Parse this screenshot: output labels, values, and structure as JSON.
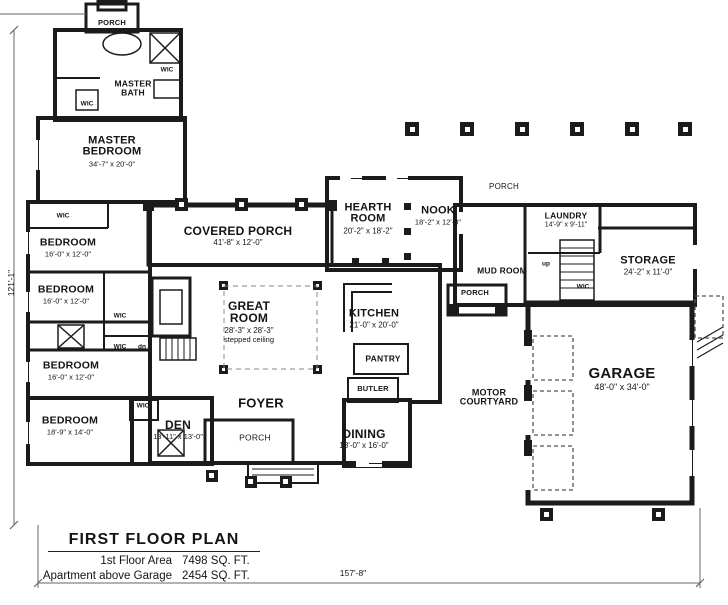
{
  "rooms": {
    "porch_nw": {
      "name": "PORCH"
    },
    "master_bath": {
      "name": "MASTER BATH"
    },
    "master_bedroom": {
      "name": "MASTER BEDROOM",
      "dims": "34'-7\" x 20'-0\""
    },
    "bedroom_1": {
      "name": "BEDROOM",
      "dims": "16'-0\" x 12'-0\""
    },
    "bedroom_2": {
      "name": "BEDROOM",
      "dims": "16'-0\" x 12'-0\""
    },
    "bedroom_3": {
      "name": "BEDROOM",
      "dims": "16'-0\" x 12'-0\""
    },
    "bedroom_4": {
      "name": "BEDROOM",
      "dims": "18'-9\" x 14'-0\""
    },
    "den": {
      "name": "DEN",
      "dims": "13'-11\" x 13'-0\""
    },
    "covered_porch": {
      "name": "COVERED PORCH",
      "dims": "41'-8\" x 12'-0\""
    },
    "great_room": {
      "name": "GREAT ROOM",
      "dims": "28'-3\" x 28'-3\"",
      "note": "stepped ceiling"
    },
    "foyer": {
      "name": "FOYER"
    },
    "porch_s": {
      "name": "PORCH"
    },
    "dining": {
      "name": "DINING",
      "dims": "18'-0\" x 16'-0\""
    },
    "butler": {
      "name": "BUTLER"
    },
    "pantry": {
      "name": "PANTRY"
    },
    "kitchen": {
      "name": "KITCHEN",
      "dims": "21'-0\" x 20'-0\""
    },
    "hearth_room": {
      "name": "HEARTH ROOM",
      "dims": "20'-2\" x 18'-2\""
    },
    "nook": {
      "name": "NOOK",
      "dims": "18'-2\" x 12'-0\""
    },
    "porch_ne": {
      "name": "PORCH"
    },
    "laundry": {
      "name": "LAUNDRY",
      "dims": "14'-9\" x 9'-11\""
    },
    "mud_room": {
      "name": "MUD ROOM"
    },
    "porch_mud": {
      "name": "PORCH"
    },
    "storage": {
      "name": "STORAGE",
      "dims": "24'-2\" x 11'-0\""
    },
    "garage": {
      "name": "GARAGE",
      "dims": "48'-0\" x 34'-0\""
    },
    "motor_courtyard": {
      "name": "MOTOR COURTYARD"
    }
  },
  "labels": {
    "wic": "WIC",
    "dn": "dn",
    "up": "up"
  },
  "dimensions": {
    "overall_width": "157'-8\"",
    "overall_height": "121'-1\""
  },
  "title_block": {
    "title": "FIRST FLOOR PLAN",
    "rows": [
      {
        "label": "1st Floor Area",
        "value": "7498 SQ. FT."
      },
      {
        "label": "Apartment above Garage",
        "value": "2454 SQ. FT."
      }
    ]
  }
}
